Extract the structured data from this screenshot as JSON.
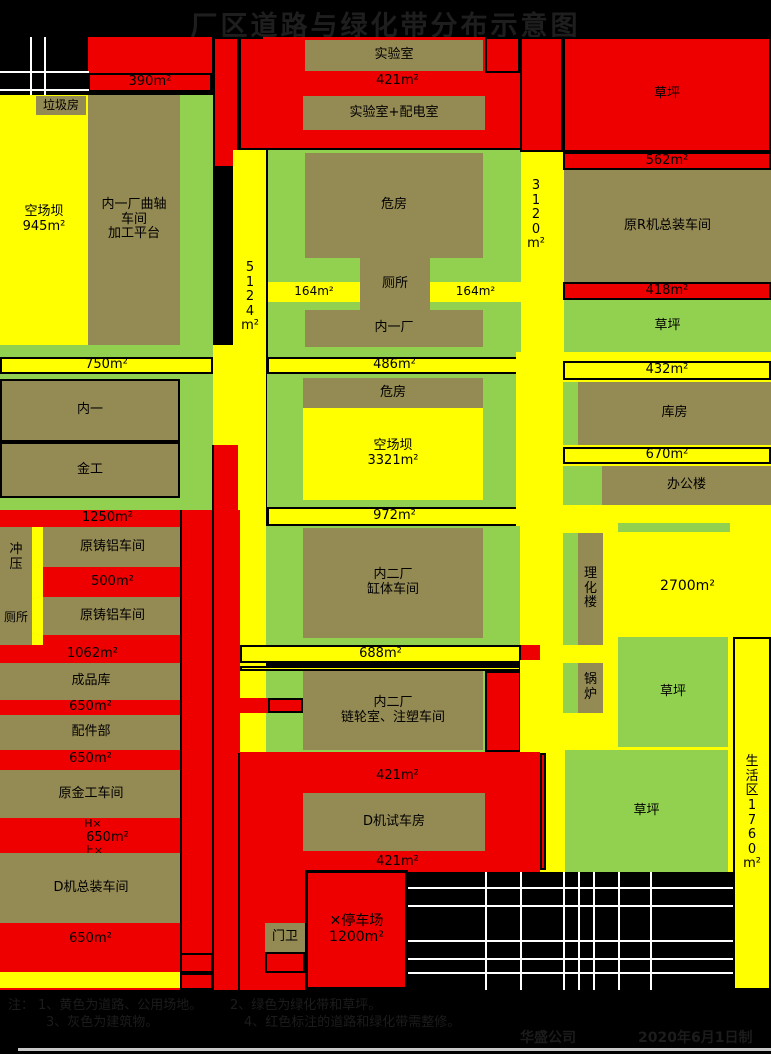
{
  "title": "厂区道路与绿化带分布示意图",
  "colors": {
    "yellow": "#ffff00",
    "green": "#92d050",
    "building": "#948a54",
    "red": "#ee0000",
    "background": "#000000",
    "road_line_white": "#ffffff",
    "divider_black": "#000000",
    "bottom_bar_gray": "#c8c8c8",
    "note_text": "#1c1c1c"
  },
  "notes": {
    "prefix": "注：",
    "n1": "1、黄色为道路、公用场地。",
    "n2": "2、绿色为绿化带和草坪。",
    "n3": "3、灰色为建筑物。",
    "n4": "4、红色标注的道路和绿化带需整修。"
  },
  "footer": {
    "company": "华盛公司",
    "date": "2020年6月1日制"
  },
  "blocks": [
    {
      "n": "west-yard",
      "l": "空场坝\n945m²",
      "x": 0,
      "y": 95,
      "w": 88,
      "h": 250,
      "f": "yellow",
      "fs": 13
    },
    {
      "n": "garbage-house",
      "l": "垃圾房",
      "x": 36,
      "y": 96,
      "w": 50,
      "h": 19,
      "f": "building",
      "fs": 12
    },
    {
      "n": "neiyi-crankshaft-workshop",
      "l": "内一厂曲轴\n车间\n加工平台",
      "x": 88,
      "y": 95,
      "w": 92,
      "h": 250,
      "f": "building",
      "fs": 13
    },
    {
      "n": "green-strip-west",
      "x": 180,
      "y": 95,
      "w": 33,
      "h": 250,
      "f": "green"
    },
    {
      "n": "red-block-nw",
      "x": 88,
      "y": 37,
      "w": 124,
      "h": 36,
      "f": "red"
    },
    {
      "n": "strip-390",
      "l": "390m²",
      "x": 88,
      "y": 73,
      "w": 124,
      "h": 19,
      "f": "red",
      "b": 1,
      "fs": 13
    },
    {
      "n": "red-col-a",
      "x": 213,
      "y": 37,
      "w": 26,
      "h": 131,
      "f": "red",
      "b": 1
    },
    {
      "n": "red-col-b",
      "x": 239,
      "y": 37,
      "w": 27,
      "h": 113,
      "f": "red",
      "b": 1
    },
    {
      "n": "red-block-north",
      "x": 263,
      "y": 37,
      "w": 257,
      "h": 111,
      "f": "red"
    },
    {
      "n": "lab",
      "l": "实验室",
      "x": 305,
      "y": 40,
      "w": 178,
      "h": 31,
      "f": "building",
      "fs": 13
    },
    {
      "n": "red-box-ne-lab",
      "x": 485,
      "y": 37,
      "w": 35,
      "h": 36,
      "f": "red",
      "b": 1
    },
    {
      "n": "text-421-north",
      "l": "421m²",
      "x": 340,
      "y": 74,
      "w": 115,
      "h": 15,
      "f": "none",
      "fs": 13
    },
    {
      "n": "lab-power-room",
      "l": "实验室+配电室",
      "x": 303,
      "y": 96,
      "w": 182,
      "h": 34,
      "f": "building",
      "fs": 13
    },
    {
      "n": "road-5124",
      "x": 233,
      "y": 150,
      "w": 33,
      "h": 603,
      "f": "yellow"
    },
    {
      "n": "road-conn-west",
      "x": 213,
      "y": 345,
      "w": 27,
      "h": 100,
      "f": "yellow"
    },
    {
      "n": "road-3120",
      "x": 520,
      "y": 150,
      "w": 44,
      "h": 210,
      "f": "yellow"
    },
    {
      "n": "green-block-1",
      "x": 268,
      "y": 150,
      "w": 253,
      "h": 207,
      "f": "green"
    },
    {
      "n": "weifang-north",
      "l": "危房",
      "x": 305,
      "y": 153,
      "w": 178,
      "h": 105,
      "f": "building",
      "fs": 13
    },
    {
      "n": "toilet-mid",
      "l": "厕所",
      "x": 360,
      "y": 258,
      "w": 70,
      "h": 52,
      "f": "building",
      "fs": 13
    },
    {
      "n": "strip-164-left",
      "l": "164m²",
      "x": 268,
      "y": 282,
      "w": 92,
      "h": 20,
      "f": "yellow",
      "fs": 12
    },
    {
      "n": "strip-164-right",
      "l": "164m²",
      "x": 430,
      "y": 282,
      "w": 91,
      "h": 20,
      "f": "yellow",
      "fs": 12
    },
    {
      "n": "neiyi-chang",
      "l": "内一厂",
      "x": 305,
      "y": 310,
      "w": 178,
      "h": 37,
      "f": "building",
      "fs": 13
    },
    {
      "n": "strip-486",
      "l": "486m²",
      "x": 267,
      "y": 357,
      "w": 255,
      "h": 17,
      "f": "yellow",
      "b": 1,
      "fs": 13
    },
    {
      "n": "green-bar-west",
      "x": 0,
      "y": 345,
      "w": 213,
      "h": 12,
      "f": "green"
    },
    {
      "n": "strip-750",
      "l": "750m²",
      "x": 0,
      "y": 357,
      "w": 213,
      "h": 17,
      "f": "yellow",
      "b": 1,
      "fs": 13
    },
    {
      "n": "green-block-west",
      "x": 0,
      "y": 374,
      "w": 213,
      "h": 136,
      "f": "green"
    },
    {
      "n": "neiyi-building",
      "l": "内一",
      "x": 0,
      "y": 379,
      "w": 180,
      "h": 63,
      "f": "building",
      "b": 1,
      "fs": 13
    },
    {
      "n": "jingong-building",
      "l": "金工",
      "x": 0,
      "y": 442,
      "w": 180,
      "h": 56,
      "f": "building",
      "b": 1,
      "fs": 13
    },
    {
      "n": "green-block-2",
      "x": 267,
      "y": 374,
      "w": 255,
      "h": 133,
      "f": "green"
    },
    {
      "n": "weifang-south",
      "l": "危房",
      "x": 303,
      "y": 378,
      "w": 180,
      "h": 30,
      "f": "building",
      "fs": 13
    },
    {
      "n": "yard-3321",
      "l": "空场坝\n3321m²",
      "x": 303,
      "y": 408,
      "w": 180,
      "h": 92,
      "f": "yellow",
      "fs": 13
    },
    {
      "n": "strip-972",
      "l": "972m²",
      "x": 267,
      "y": 507,
      "w": 255,
      "h": 19,
      "f": "yellow",
      "b": 1,
      "fs": 13
    },
    {
      "n": "yellow-east-mid",
      "x": 516,
      "y": 352,
      "w": 255,
      "h": 308,
      "f": "yellow"
    },
    {
      "n": "strip-432",
      "l": "432m²",
      "x": 563,
      "y": 361,
      "w": 208,
      "h": 19,
      "f": "yellow",
      "b": 1,
      "fs": 13
    },
    {
      "n": "green-strip-kufang",
      "x": 563,
      "y": 382,
      "w": 15,
      "h": 63,
      "f": "green"
    },
    {
      "n": "kufang",
      "l": "库房",
      "x": 578,
      "y": 382,
      "w": 193,
      "h": 63,
      "f": "building",
      "fs": 13
    },
    {
      "n": "strip-670",
      "l": "670m²",
      "x": 563,
      "y": 447,
      "w": 208,
      "h": 17,
      "f": "yellow",
      "b": 1,
      "fs": 13
    },
    {
      "n": "green-strip-office",
      "x": 563,
      "y": 466,
      "w": 39,
      "h": 39,
      "f": "green"
    },
    {
      "n": "office-building",
      "l": "办公楼",
      "x": 602,
      "y": 466,
      "w": 169,
      "h": 39,
      "f": "building",
      "fs": 13
    },
    {
      "n": "green-bar-east",
      "x": 618,
      "y": 523,
      "w": 112,
      "h": 9,
      "f": "green"
    },
    {
      "n": "green-strip-lihua",
      "x": 563,
      "y": 533,
      "w": 15,
      "h": 112,
      "f": "green"
    },
    {
      "n": "lihua-building",
      "l": "理\n化\n楼",
      "x": 578,
      "y": 533,
      "w": 25,
      "h": 112,
      "f": "building",
      "fs": 13
    },
    {
      "n": "text-2700",
      "l": "2700m²",
      "x": 640,
      "y": 578,
      "w": 95,
      "h": 18,
      "f": "none",
      "fs": 14
    },
    {
      "n": "red-west-zone",
      "x": 0,
      "y": 510,
      "w": 240,
      "h": 480,
      "f": "red"
    },
    {
      "n": "red-col-seg",
      "x": 213,
      "y": 445,
      "w": 25,
      "h": 65,
      "f": "red"
    },
    {
      "n": "text-1250",
      "l": "1250m²",
      "x": 60,
      "y": 511,
      "w": 95,
      "h": 15,
      "f": "none",
      "fs": 13
    },
    {
      "n": "chongya-toilet-building",
      "x": 0,
      "y": 527,
      "w": 32,
      "h": 118,
      "f": "building"
    },
    {
      "n": "chongya-label",
      "l": "冲\n压",
      "x": 4,
      "y": 535,
      "w": 24,
      "h": 46,
      "f": "none",
      "fs": 13
    },
    {
      "n": "toilet-west-label",
      "l": "厕所",
      "x": 0,
      "y": 610,
      "w": 32,
      "h": 16,
      "f": "none",
      "fs": 12
    },
    {
      "n": "yellow-sliver-west",
      "x": 32,
      "y": 527,
      "w": 11,
      "h": 118,
      "f": "yellow"
    },
    {
      "n": "cast-aluminum-workshop-1",
      "l": "原铸铝车间",
      "x": 43,
      "y": 527,
      "w": 139,
      "h": 40,
      "f": "building",
      "fs": 13
    },
    {
      "n": "text-500",
      "l": "500m²",
      "x": 75,
      "y": 575,
      "w": 75,
      "h": 15,
      "f": "none",
      "fs": 13
    },
    {
      "n": "cast-aluminum-workshop-2",
      "l": "原铸铝车间",
      "x": 43,
      "y": 597,
      "w": 139,
      "h": 38,
      "f": "building",
      "fs": 13
    },
    {
      "n": "text-1062",
      "l": "1062m²",
      "x": 45,
      "y": 647,
      "w": 95,
      "h": 15,
      "f": "none",
      "fs": 13
    },
    {
      "n": "chengpinku",
      "l": "成品库",
      "x": 0,
      "y": 663,
      "w": 182,
      "h": 37,
      "f": "building",
      "fs": 13
    },
    {
      "n": "text-650-1",
      "l": "650m²",
      "x": 53,
      "y": 700,
      "w": 75,
      "h": 15,
      "f": "none",
      "fs": 13
    },
    {
      "n": "peijianbu",
      "l": "配件部",
      "x": 0,
      "y": 715,
      "w": 182,
      "h": 35,
      "f": "building",
      "fs": 13
    },
    {
      "n": "text-650-2",
      "l": "650m²",
      "x": 53,
      "y": 752,
      "w": 75,
      "h": 15,
      "f": "none",
      "fs": 13
    },
    {
      "n": "yuanjingong-workshop",
      "l": "原金工车间",
      "x": 0,
      "y": 770,
      "w": 182,
      "h": 48,
      "f": "building",
      "fs": 13
    },
    {
      "n": "text-hx-marker",
      "l": "H×",
      "x": 76,
      "y": 818,
      "w": 34,
      "h": 13,
      "f": "none",
      "fs": 11
    },
    {
      "n": "text-650-3",
      "l": "650m²",
      "x": 70,
      "y": 831,
      "w": 75,
      "h": 14,
      "f": "none",
      "fs": 13
    },
    {
      "n": "text-lx-marker",
      "l": "上×",
      "x": 76,
      "y": 845,
      "w": 34,
      "h": 12,
      "f": "none",
      "fs": 11
    },
    {
      "n": "d-assembly-workshop",
      "l": "D机总装车间",
      "x": 0,
      "y": 853,
      "w": 182,
      "h": 70,
      "f": "building",
      "fs": 13
    },
    {
      "n": "text-650-4",
      "l": "650m²",
      "x": 53,
      "y": 932,
      "w": 75,
      "h": 15,
      "f": "none",
      "fs": 13
    },
    {
      "n": "yellow-strip-sw",
      "x": 0,
      "y": 972,
      "w": 180,
      "h": 16,
      "f": "yellow"
    },
    {
      "n": "green-block-3",
      "x": 266,
      "y": 526,
      "w": 254,
      "h": 119,
      "f": "green"
    },
    {
      "n": "neierchang-gangti",
      "l": "内二厂\n缸体车间",
      "x": 303,
      "y": 528,
      "w": 180,
      "h": 110,
      "f": "building",
      "fs": 13
    },
    {
      "n": "strip-688",
      "l": "688m²",
      "x": 240,
      "y": 645,
      "w": 281,
      "h": 18,
      "f": "yellow",
      "b": 1,
      "fs": 13
    },
    {
      "n": "strip-thin",
      "x": 240,
      "y": 666,
      "w": 281,
      "h": 5,
      "f": "yellow",
      "b": 1
    },
    {
      "n": "red-east-g4",
      "x": 521,
      "y": 645,
      "w": 19,
      "h": 107,
      "f": "red"
    },
    {
      "n": "green-block-4",
      "x": 266,
      "y": 671,
      "w": 254,
      "h": 81,
      "f": "green"
    },
    {
      "n": "red-bar-conn",
      "x": 230,
      "y": 698,
      "w": 73,
      "h": 15,
      "f": "red"
    },
    {
      "n": "red-bar-box",
      "x": 268,
      "y": 698,
      "w": 35,
      "h": 15,
      "f": "red",
      "b": 1
    },
    {
      "n": "neierchang-lianlun",
      "l": "内二厂\n链轮室、注塑车间",
      "x": 303,
      "y": 671,
      "w": 180,
      "h": 79,
      "f": "building",
      "fs": 13
    },
    {
      "n": "red-box-g4",
      "x": 485,
      "y": 671,
      "w": 36,
      "h": 81,
      "f": "red",
      "b": 1
    },
    {
      "n": "yellow-se",
      "x": 520,
      "y": 660,
      "w": 213,
      "h": 212,
      "f": "yellow"
    },
    {
      "n": "green-strip-boiler",
      "x": 563,
      "y": 663,
      "w": 15,
      "h": 50,
      "f": "green"
    },
    {
      "n": "boiler",
      "l": "锅\n炉",
      "x": 578,
      "y": 663,
      "w": 25,
      "h": 50,
      "f": "building",
      "fs": 13
    },
    {
      "n": "lawn-mid-east",
      "l": "草坪",
      "x": 618,
      "y": 637,
      "w": 110,
      "h": 110,
      "f": "green",
      "fs": 13
    },
    {
      "n": "red-south-zone-a",
      "x": 213,
      "y": 752,
      "w": 327,
      "h": 120,
      "f": "red"
    },
    {
      "n": "red-south-zone-b",
      "x": 213,
      "y": 872,
      "w": 195,
      "h": 118,
      "f": "red"
    },
    {
      "n": "lawn-south-east",
      "l": "草坪",
      "x": 565,
      "y": 750,
      "w": 163,
      "h": 122,
      "f": "green",
      "fs": 13
    },
    {
      "n": "red-sliver-se",
      "x": 540,
      "y": 753,
      "w": 6,
      "h": 117,
      "f": "red",
      "b": 1
    },
    {
      "n": "text-421-a",
      "l": "421m²",
      "x": 360,
      "y": 769,
      "w": 75,
      "h": 15,
      "f": "none",
      "fs": 13
    },
    {
      "n": "d-test-house",
      "l": "D机试车房",
      "x": 303,
      "y": 793,
      "w": 182,
      "h": 58,
      "f": "building",
      "fs": 13
    },
    {
      "n": "text-421-b",
      "l": "421m²",
      "x": 360,
      "y": 855,
      "w": 75,
      "h": 15,
      "f": "none",
      "fs": 13
    },
    {
      "n": "parking-lot",
      "l": "✕停车场\n1200m²",
      "x": 305,
      "y": 870,
      "w": 103,
      "h": 120,
      "f": "red",
      "b": 2,
      "fs": 14
    },
    {
      "n": "menwei",
      "l": "门卫",
      "x": 265,
      "y": 923,
      "w": 40,
      "h": 29,
      "f": "building",
      "fs": 13
    },
    {
      "n": "menwei-box",
      "x": 265,
      "y": 952,
      "w": 40,
      "h": 21,
      "f": "red",
      "b": 1
    },
    {
      "n": "red-gate-box-1",
      "x": 180,
      "y": 953,
      "w": 33,
      "h": 20,
      "f": "red",
      "b": 1
    },
    {
      "n": "red-gate-box-2",
      "x": 180,
      "y": 973,
      "w": 33,
      "h": 17,
      "f": "red",
      "b": 1
    },
    {
      "n": "living-area-strip",
      "l": "生\n活\n区\n1\n7\n6\n0\nm²",
      "x": 733,
      "y": 637,
      "w": 38,
      "h": 353,
      "f": "yellow",
      "b": 1,
      "fs": 13
    },
    {
      "n": "red-ne-left",
      "x": 520,
      "y": 37,
      "w": 43,
      "h": 115,
      "f": "red",
      "b": 1
    },
    {
      "n": "red-ne-lawn",
      "l": "草坪",
      "x": 563,
      "y": 37,
      "w": 208,
      "h": 115,
      "f": "red",
      "b": 1,
      "fs": 13
    },
    {
      "n": "strip-562",
      "l": "562m²",
      "x": 563,
      "y": 152,
      "w": 208,
      "h": 18,
      "f": "red",
      "b": 1,
      "fs": 13
    },
    {
      "n": "r-assembly-workshop",
      "l": "原R机总装车间",
      "x": 564,
      "y": 170,
      "w": 207,
      "h": 112,
      "f": "building",
      "fs": 13
    },
    {
      "n": "strip-418",
      "l": "418m²",
      "x": 563,
      "y": 282,
      "w": 208,
      "h": 18,
      "f": "red",
      "b": 1,
      "fs": 13
    },
    {
      "n": "lawn-ne",
      "l": "草坪",
      "x": 564,
      "y": 300,
      "w": 207,
      "h": 52,
      "f": "green",
      "fs": 13
    },
    {
      "n": "road-5124-label",
      "l": "5\n1\n2\n4\nm²",
      "x": 236,
      "y": 250,
      "w": 28,
      "h": 95,
      "f": "none",
      "fs": 13
    },
    {
      "n": "road-3120-label",
      "l": "3\n1\n2\n0\nm²",
      "x": 522,
      "y": 168,
      "w": 28,
      "h": 95,
      "f": "none",
      "fs": 13
    }
  ],
  "lines": [
    {
      "n": "divider-line",
      "x": 180,
      "y": 510,
      "w": 2,
      "h": 480,
      "c": "black"
    },
    {
      "n": "divider-line",
      "x": 212,
      "y": 445,
      "w": 2,
      "h": 545,
      "c": "black"
    },
    {
      "n": "divider-line",
      "x": 238,
      "y": 753,
      "w": 2,
      "h": 237,
      "c": "black"
    },
    {
      "n": "road-marking-line",
      "x": 30,
      "y": 37,
      "w": 2,
      "h": 58,
      "c": "white"
    },
    {
      "n": "road-marking-line",
      "x": 44,
      "y": 37,
      "w": 2,
      "h": 58,
      "c": "white"
    },
    {
      "n": "road-marking-line",
      "x": 0,
      "y": 71,
      "w": 89,
      "h": 2,
      "c": "white"
    },
    {
      "n": "road-marking-line",
      "x": 0,
      "y": 89,
      "w": 89,
      "h": 2,
      "c": "white"
    },
    {
      "n": "grid-line",
      "x": 485,
      "y": 872,
      "w": 2,
      "h": 118,
      "c": "white"
    },
    {
      "n": "grid-line",
      "x": 520,
      "y": 872,
      "w": 2,
      "h": 118,
      "c": "white"
    },
    {
      "n": "grid-line",
      "x": 563,
      "y": 872,
      "w": 2,
      "h": 118,
      "c": "white"
    },
    {
      "n": "grid-line",
      "x": 578,
      "y": 872,
      "w": 2,
      "h": 118,
      "c": "white"
    },
    {
      "n": "grid-line",
      "x": 593,
      "y": 872,
      "w": 2,
      "h": 118,
      "c": "white"
    },
    {
      "n": "grid-line",
      "x": 618,
      "y": 872,
      "w": 2,
      "h": 118,
      "c": "white"
    },
    {
      "n": "grid-line",
      "x": 650,
      "y": 872,
      "w": 2,
      "h": 118,
      "c": "white"
    },
    {
      "n": "grid-line",
      "x": 408,
      "y": 887,
      "w": 325,
      "h": 2,
      "c": "white"
    },
    {
      "n": "grid-line",
      "x": 408,
      "y": 905,
      "w": 325,
      "h": 2,
      "c": "white"
    },
    {
      "n": "grid-line",
      "x": 408,
      "y": 940,
      "w": 325,
      "h": 2,
      "c": "white"
    },
    {
      "n": "grid-line",
      "x": 408,
      "y": 958,
      "w": 325,
      "h": 2,
      "c": "white"
    },
    {
      "n": "grid-line",
      "x": 408,
      "y": 972,
      "w": 325,
      "h": 2,
      "c": "white"
    },
    {
      "n": "bottom-bar",
      "x": 18,
      "y": 1048,
      "w": 753,
      "h": 3,
      "c": "#c8c8c8"
    }
  ]
}
